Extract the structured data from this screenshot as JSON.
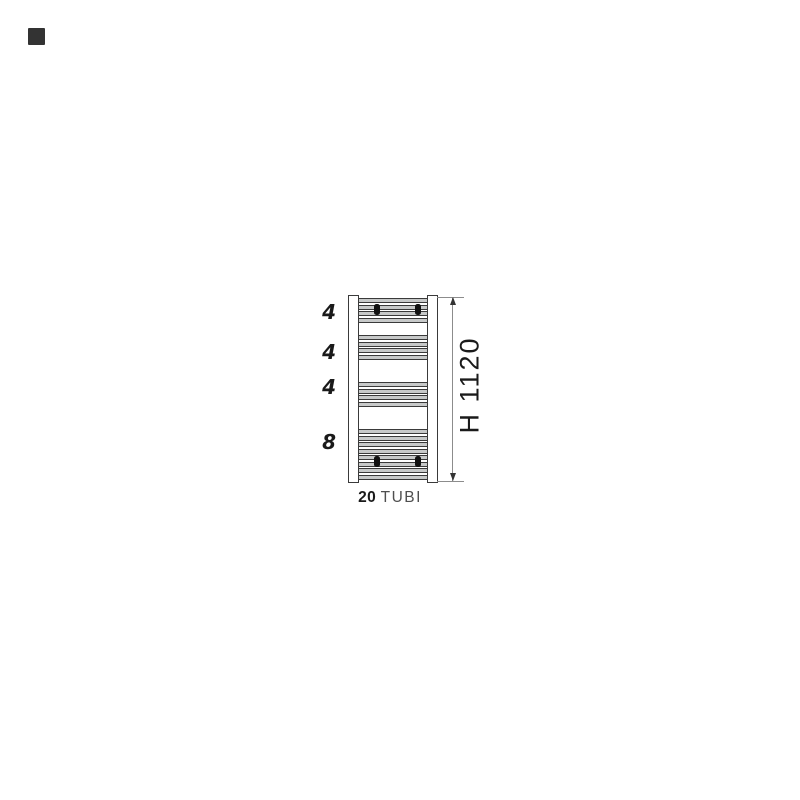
{
  "diagram": {
    "tube_group_labels": [
      "4",
      "4",
      "4",
      "8"
    ],
    "tube_group_counts": [
      4,
      4,
      4,
      8
    ],
    "height_dimension": "H 1120",
    "total_tubes_bold": "20",
    "total_tubes_text": "TUBI"
  },
  "colors": {
    "tube_fill": "#c7c9c9",
    "outline_dark": "#3a3a3a",
    "dimension_line": "#8c8c8c",
    "text_primary": "#1a1a1a",
    "text_secondary": "#4f4f4f",
    "swatch": "#333333"
  }
}
